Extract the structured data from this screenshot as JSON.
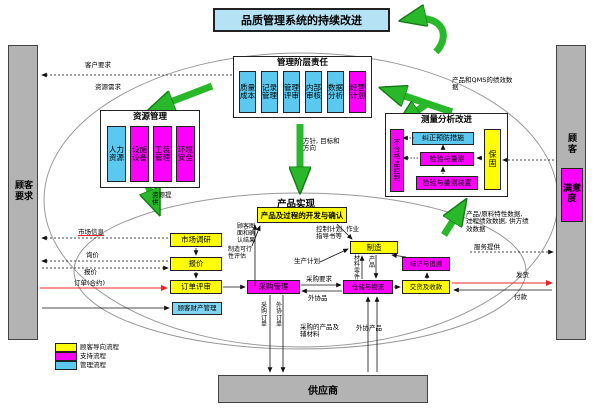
{
  "banner": {
    "label": "品质管理系统的持续改进"
  },
  "left_bar": {
    "label": "顾客要求"
  },
  "right_bar": {
    "top": "顾客",
    "satisfaction": "满意度"
  },
  "management": {
    "title": "管理阶层责任",
    "items": [
      "质量成本",
      "记录管理",
      "管理评审",
      "内部审核",
      "数据分析",
      "经营计划"
    ]
  },
  "resources": {
    "title": "资源管理",
    "items": [
      "人力资源",
      "设施设备",
      "工装管理",
      "环境安全"
    ]
  },
  "measurement": {
    "title": "测量分析改进",
    "nonconforming": "不合格品控制",
    "warranty": "保固",
    "corrective": "纠正预防措施",
    "inspection": "检验与量测",
    "devices": "检验与量测装置"
  },
  "product": {
    "title": "产品实现",
    "development": "产品及过程的开发与确认",
    "market_research": "市场调研",
    "quote": "报价",
    "order_review": "订单评审",
    "customer_property": "顾客财产管理",
    "purchasing": "采购管理",
    "manufacturing": "制造",
    "traceability": "标识与追溯",
    "warehouse": "仓储与物流",
    "delivery": "交货及收款"
  },
  "supplier": {
    "label": "供应商"
  },
  "legend": {
    "items": [
      {
        "label": "顾客导向流程",
        "color": "#ffff00"
      },
      {
        "label": "支持流程",
        "color": "#ff00ff"
      },
      {
        "label": "管理流程",
        "color": "#5bc8f0"
      }
    ]
  },
  "annotations": {
    "customer_requirement": "客户要求",
    "resource_demand": "资源需求",
    "resource_supply": "资源提供",
    "policy_goal": "方针, 目标和方向",
    "qms_performance": "产品和QMS的绩效数据",
    "product_data": "产品/原料特性数据, 过程绩效数据, 供方绩效数据",
    "service_provide": "服务提供",
    "shipping": "发货",
    "payment": "付款",
    "market_info": "市场信息",
    "inquiry": "询价",
    "quotation_out": "报价",
    "order_contract": "订单(合约)",
    "customer_drawing": "顾客图面和确认结果",
    "control_plan": "控制计划, 作业指导书等",
    "feasibility": "制造可行性评估",
    "production_plan": "生产计划",
    "material_parts": "材料零件",
    "product_flow": "产品",
    "purchase_req": "采购要求",
    "outsourced_item": "外协品",
    "purchase_order": "采购订单",
    "outsource_order": "外协订单",
    "purchased_products": "采购的产品及辅材料",
    "outsourced_products": "外协产品"
  },
  "colors": {
    "customer_oriented": "#ffff00",
    "support": "#ff00ff",
    "management_process": "#5bc8f0",
    "banner_bg": "#b5e3f5",
    "bar_bg": "#b3b3b3",
    "green_arrow": "#29b829",
    "red_flow": "#e8262a"
  }
}
